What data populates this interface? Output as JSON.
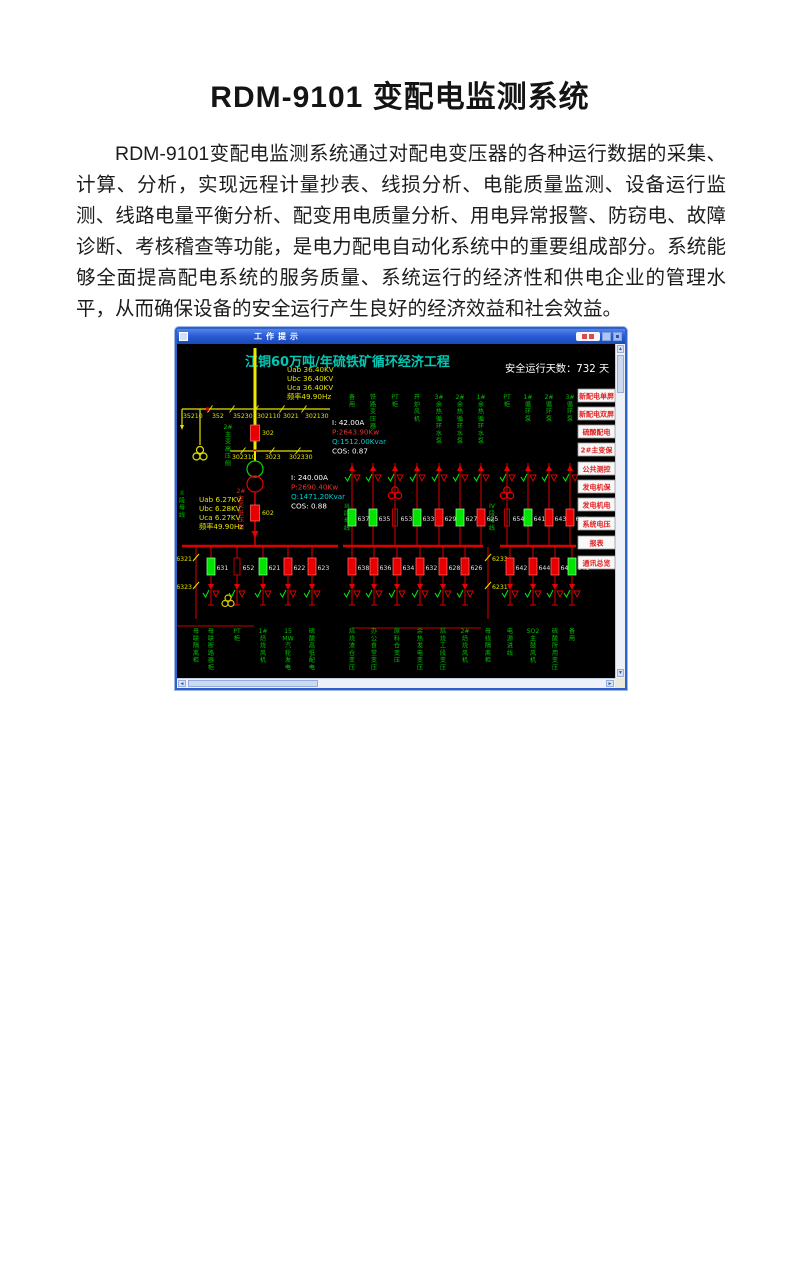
{
  "document": {
    "title": "RDM-9101 变配电监测系统",
    "body": "RDM-9101变配电监测系统通过对配电变压器的各种运行数据的采集、计算、分析，实现远程计量抄表、线损分析、电能质量监测、设备运行监测、线路电量平衡分析、配变用电质量分析、用电异常报警、防窃电、故障诊断、考核稽查等功能，是电力配电自动化系统中的重要组成部分。系统能够全面提高配电系统的服务质量、系统运行的经济性和供电企业的管理水平，从而确保设备的安全运行产生良好的经济效益和社会效益。"
  },
  "app_window": {
    "title": "工作提示"
  },
  "scada": {
    "screen_title": "江铜60万吨/年硫铁矿循环经济工程",
    "safe_days": "安全运行天数：732 天",
    "colors": {
      "yellow": "#e2e200",
      "bright_yellow": "#f0e800",
      "green_text": "#00c000",
      "green_on": "#00e400",
      "red": "#e80000",
      "wire_red": "#cc0000",
      "bus_red": "#dd0000",
      "cyan": "#00cccc",
      "title_cyan": "#00c8b4",
      "white": "#ffffff",
      "meas_red": "#e83030",
      "btn_text_red": "#e02020"
    },
    "hv": {
      "voltages": [
        "Uab 36.40KV",
        "Ubc 36.40KV",
        "Uca 36.40KV",
        "频率49.90Hz"
      ],
      "switch_top": [
        "35210",
        "352",
        "35230",
        "302110",
        "3021",
        "302130"
      ],
      "switch_mid": [
        "302310",
        "3023",
        "302330"
      ],
      "breaker": "302",
      "side_label": [
        "2#",
        "主",
        "变",
        "高",
        "压",
        "侧"
      ],
      "meas": [
        {
          "t": "I:  42.00A",
          "c": "#ffffff"
        },
        {
          "t": "P:2643.90Kw",
          "c": "#e83030"
        },
        {
          "t": "Q:1512.00Kvar",
          "c": "#00cccc"
        },
        {
          "t": "COS:  0.87",
          "c": "#ffffff"
        }
      ]
    },
    "lv": {
      "voltages": [
        "Uab 6.27KV",
        "Ubc 6.28KV",
        "Uca 6.27KV",
        "频率49.90Hz"
      ],
      "breaker": "602",
      "side_label": [
        "2#",
        "主",
        "变",
        "低",
        "压",
        "侧"
      ],
      "meas": [
        {
          "t": "I: 240.00A",
          "c": "#ffffff"
        },
        {
          "t": "P:2690.40Kw",
          "c": "#e83030"
        },
        {
          "t": "Q:1471.20Kvar",
          "c": "#00cccc"
        },
        {
          "t": "COS:  0.88",
          "c": "#ffffff"
        }
      ]
    },
    "bus_labels": [
      {
        "x": 182,
        "y": 494,
        "tokens": [
          "II",
          "段",
          "母",
          "线"
        ]
      },
      {
        "x": 347,
        "y": 507,
        "tokens": [
          "III",
          "段",
          "母",
          "线"
        ]
      },
      {
        "x": 492,
        "y": 507,
        "tokens": [
          "IV",
          "段",
          "母",
          "线"
        ]
      }
    ],
    "upper_feeders": [
      {
        "x": 352,
        "num": "637",
        "state": "green",
        "label": [
          "备",
          "用"
        ]
      },
      {
        "x": 373,
        "num": "635",
        "state": "green",
        "label": [
          "铁",
          "路",
          "变",
          "压",
          "器"
        ]
      },
      {
        "x": 395,
        "num": "653",
        "state": "pt",
        "label": [
          "PT",
          "柜"
        ]
      },
      {
        "x": 417,
        "num": "633",
        "state": "green",
        "label": [
          "开",
          "炉",
          "风",
          "机"
        ]
      },
      {
        "x": 439,
        "num": "629",
        "state": "red",
        "label": [
          "3#",
          "余",
          "热",
          "循",
          "环",
          "水",
          "泵"
        ]
      },
      {
        "x": 460,
        "num": "627",
        "state": "green",
        "label": [
          "2#",
          "余",
          "热",
          "循",
          "环",
          "水",
          "泵"
        ]
      },
      {
        "x": 481,
        "num": "625",
        "state": "red",
        "label": [
          "1#",
          "余",
          "热",
          "循",
          "环",
          "水",
          "泵"
        ]
      },
      {
        "x": 507,
        "num": "654",
        "state": "pt",
        "label": [
          "PT",
          "柜"
        ]
      },
      {
        "x": 528,
        "num": "641",
        "state": "green",
        "label": [
          "1#",
          "循",
          "环",
          "泵"
        ]
      },
      {
        "x": 549,
        "num": "643",
        "state": "red",
        "label": [
          "2#",
          "循",
          "环",
          "泵"
        ]
      },
      {
        "x": 570,
        "num": "645",
        "state": "red",
        "label": [
          "3#",
          "循",
          "环",
          "泵"
        ]
      }
    ],
    "lower_feeders": [
      {
        "x": 196,
        "state": "disc",
        "side": "left",
        "disc": [
          "6321",
          "6323"
        ],
        "label": [
          "母",
          "联",
          "隔",
          "离",
          "柜"
        ]
      },
      {
        "x": 211,
        "num": "631",
        "state": "green",
        "label": [
          "母",
          "联",
          "断",
          "路",
          "器",
          "柜"
        ]
      },
      {
        "x": 237,
        "num": "652",
        "state": "switch",
        "pt": true,
        "label": [
          "PT",
          "柜"
        ]
      },
      {
        "x": 263,
        "num": "621",
        "state": "green",
        "label": [
          "1#",
          "焙",
          "烧",
          "风",
          "机"
        ]
      },
      {
        "x": 288,
        "num": "622",
        "state": "red",
        "label": [
          "15",
          "MW",
          "汽",
          "轮",
          "发",
          "电"
        ]
      },
      {
        "x": 312,
        "num": "623",
        "state": "red",
        "label": [
          "硫",
          "酸",
          "高",
          "低",
          "配",
          "电"
        ]
      },
      {
        "x": 352,
        "num": "638",
        "state": "red",
        "label": [
          "焙",
          "烧",
          "渣",
          "仓",
          "变",
          "压"
        ]
      },
      {
        "x": 374,
        "num": "636",
        "state": "red",
        "label": [
          "办",
          "公",
          "食",
          "堂",
          "变",
          "压"
        ]
      },
      {
        "x": 397,
        "num": "634",
        "state": "red",
        "label": [
          "原",
          "料",
          "仓",
          "变",
          "压"
        ]
      },
      {
        "x": 420,
        "num": "632",
        "state": "red",
        "label": [
          "余",
          "热",
          "发",
          "电",
          "变",
          "压"
        ]
      },
      {
        "x": 443,
        "num": "628",
        "state": "red",
        "label": [
          "焙",
          "烧",
          "工",
          "段",
          "变",
          "压"
        ]
      },
      {
        "x": 465,
        "num": "626",
        "state": "red",
        "label": [
          "2#",
          "焙",
          "烧",
          "风",
          "机"
        ]
      },
      {
        "x": 488,
        "state": "disc",
        "side": "right",
        "disc": [
          "6233",
          "6231"
        ],
        "label": [
          "母",
          "线",
          "隔",
          "离",
          "柜"
        ]
      },
      {
        "x": 510,
        "num": "642",
        "state": "red",
        "label": [
          "电",
          "源",
          "进",
          "线"
        ]
      },
      {
        "x": 533,
        "num": "644",
        "state": "red",
        "label": [
          "SO2",
          "主",
          "鼓",
          "风",
          "机"
        ]
      },
      {
        "x": 555,
        "num": "646",
        "state": "red",
        "label": [
          "硫",
          "酸",
          "所",
          "用",
          "变",
          "压"
        ]
      },
      {
        "x": 572,
        "num": "648",
        "state": "green",
        "label": [
          "备",
          "用"
        ]
      }
    ],
    "nav_buttons": [
      "新配电单屏",
      "新配电双屏",
      "硫酸配电",
      "2#主变保",
      "公共测控",
      "发电机保",
      "发电机电",
      "系统电压",
      "报表",
      "通讯总览"
    ]
  }
}
